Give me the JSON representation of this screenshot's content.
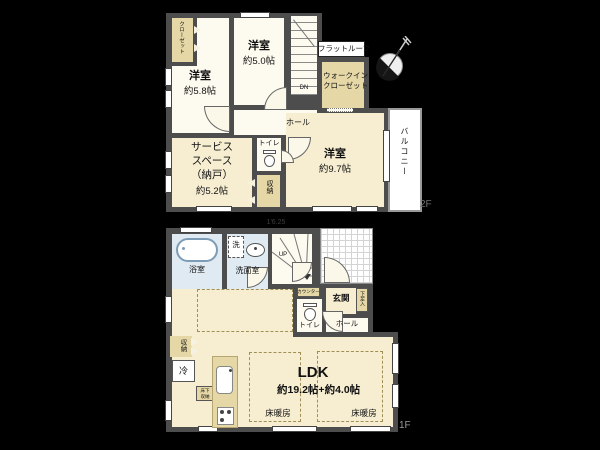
{
  "colors": {
    "wall": "#4d4d4d",
    "floor_light": "#fdfaef",
    "floor_warm": "#f7eed2",
    "closet_tan": "#e5d7a6",
    "bath_blue": "#dfeaf2",
    "background": "#000000"
  },
  "floor2": {
    "tag": "2F",
    "closet": "クローゼット",
    "room58_name": "洋室",
    "room58_size": "約5.8帖",
    "room50_name": "洋室",
    "room50_size": "約5.0帖",
    "stairs_down": "DN",
    "flat_roof": "フラットルーフ",
    "wic_line1": "ウォークイン",
    "wic_line2": "クローゼット",
    "hall": "ホール",
    "toilet": "トイレ",
    "storage": "収納",
    "service_line1": "サービス",
    "service_line2": "スペース",
    "service_line3": "（納戸）",
    "service_size": "約5.2帖",
    "room97_name": "洋室",
    "room97_size": "約9.7帖",
    "balcony": "バルコニー"
  },
  "floor1": {
    "tag": "1F",
    "note": "1'6.25",
    "bath": "浴室",
    "washer": "洗",
    "washroom": "洗面室",
    "stairs_up": "UP",
    "entrance": "玄関",
    "shoe_cabinet": "下足入",
    "hall": "ホール",
    "counter": "カウンター",
    "toilet": "トイレ",
    "storage": "収納",
    "fridge": "冷",
    "underfloor_line1": "床下",
    "underfloor_line2": "収納",
    "ldk_name": "LDK",
    "ldk_size": "約19.2帖+約4.0帖",
    "heating_left": "床暖房",
    "heating_right": "床暖房"
  }
}
